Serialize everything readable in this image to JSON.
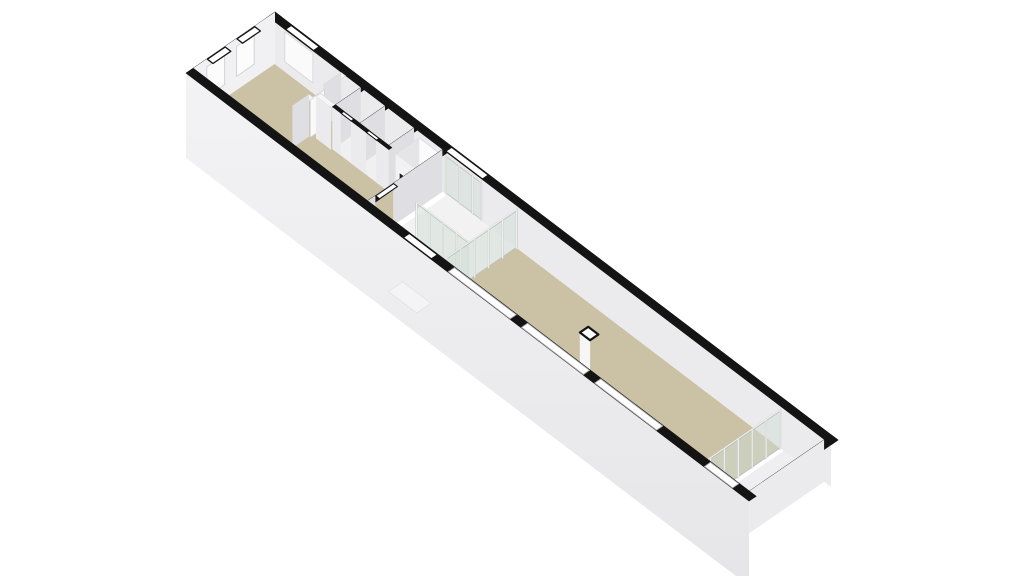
{
  "meta": {
    "description": "3D axonometric floor plan of a long narrow building",
    "background": "#ffffff",
    "rooms": [
      "living-room",
      "bathroom",
      "entrance-hall",
      "main-hall",
      "end-room"
    ]
  },
  "palette": {
    "black": "#141414",
    "tan": "#cbc1a5",
    "vest": "#f2f2f3",
    "podFloor": "#f0f0f1",
    "end": "#efeff1",
    "topWhite": "#f5f5f6",
    "topStroke": "#d8d8db",
    "faceS": "#ebebed",
    "faceW": "#dfdfe3",
    "extFace": "#f1f1f3",
    "extGrad": "url(#ext)",
    "win": "#ffffff",
    "winExt": "#fcfcfd",
    "winGlassInner": "#fafafa",
    "frame": "#d3d3d7",
    "door": "#f9f9fa",
    "cabTop": "#fbfbfc",
    "cabW": "#e5e5e8",
    "cabS": "#f2f2f4",
    "panel": "#1e1e1e",
    "colW": "#e9e9ec",
    "colS": "#f6f6f7",
    "stoop": "#f4f4f6",
    "stoopEdge": "#e2e2e5",
    "longWin": "#a6a6ab",
    "glassFill": "rgba(208,221,214,0.5)",
    "glassStroke": "#b9c1bb",
    "post": "#f6f6f7",
    "postStroke": "#c6cbc7",
    "rail": "#f8f8f9"
  },
  "projection": {
    "origin": [
      275,
      54
    ],
    "axis_x": [
      5.63,
      4.28
    ],
    "axis_y": [
      -5.93,
      4.07
    ],
    "wall_height_px": 42,
    "plinth_bottom_px": -43,
    "post_interval": 2.35
  },
  "building": {
    "length_units": 100,
    "width_units": 15,
    "wall_thickness": 1.2
  },
  "scene": [
    {
      "t": "top",
      "r": [
        0,
        0,
        100,
        1.2
      ],
      "h": 42,
      "f": "black",
      "s": "black",
      "sw": 0.6,
      "name": "north-facade-wall-top"
    },
    {
      "t": "faceS",
      "x1": 0,
      "x2": 100,
      "y": 1.2,
      "h1": 42,
      "h2": 0,
      "f": "faceS",
      "name": "north-facade-inner-face"
    },
    {
      "t": "faceS",
      "x1": 3,
      "x2": 8,
      "y": 1.2,
      "h1": 40,
      "h2": 10,
      "f": "winGlassInner",
      "s": "frame",
      "sw": 0.8,
      "name": "north-window-inner-pane"
    },
    {
      "t": "glass",
      "axis": "x",
      "at": 1.2,
      "from": 31.5,
      "to": 38,
      "hh": 40,
      "name": "entry-glazing-inner"
    },
    {
      "t": "band",
      "r": [
        3,
        0.12,
        8,
        1.08
      ],
      "h": 42,
      "f": "win",
      "s": "black",
      "sw": 1.3,
      "name": "north-window-cut"
    },
    {
      "t": "band",
      "r": [
        31.5,
        0.12,
        38,
        1.08
      ],
      "h": 42,
      "f": "win",
      "s": "black",
      "sw": 1.1,
      "name": "entry-glazing-cut"
    },
    {
      "t": "top",
      "r": [
        0,
        0,
        1.2,
        15
      ],
      "h": 42,
      "f": "black",
      "s": "black",
      "sw": 0.6,
      "name": "west-end-wall-top"
    },
    {
      "t": "faceW",
      "x": 0,
      "y1": 0,
      "y2": 15,
      "h1": 42,
      "h2": -43,
      "f": "extFace",
      "name": "west-end-exterior-face"
    },
    {
      "t": "faceW",
      "x": 0,
      "y1": 3.5,
      "y2": 6.5,
      "h1": 34,
      "h2": 4,
      "f": "winExt",
      "s": "frame",
      "sw": 1,
      "name": "west-window-1"
    },
    {
      "t": "faceW",
      "x": 0,
      "y1": 8.5,
      "y2": 11.5,
      "h1": 34,
      "h2": 4,
      "f": "winExt",
      "s": "frame",
      "sw": 1,
      "name": "west-window-2"
    },
    {
      "t": "band",
      "r": [
        0.1,
        3.5,
        1.1,
        6.5
      ],
      "h": 42,
      "f": "win",
      "s": "black",
      "sw": 1.3,
      "name": "west-window-1-cut"
    },
    {
      "t": "band",
      "r": [
        0.1,
        8.5,
        1.1,
        11.5
      ],
      "h": 42,
      "f": "win",
      "s": "black",
      "sw": 1.3,
      "name": "west-window-2-cut"
    },
    {
      "t": "top",
      "r": [
        1.2,
        1.2,
        31,
        13.8
      ],
      "h": 0,
      "f": "tan",
      "name": "living-room-floor"
    },
    {
      "t": "top",
      "r": [
        31.8,
        1.2,
        44,
        13.8
      ],
      "h": 0,
      "f": "vest",
      "name": "entrance-hall-floor"
    },
    {
      "t": "top",
      "r": [
        16.5,
        1.2,
        26.5,
        6
      ],
      "h": 0,
      "f": "podFloor",
      "name": "bathroom-floor"
    },
    {
      "t": "top",
      "r": [
        44,
        1.2,
        91,
        13.8
      ],
      "h": 0,
      "f": "tan",
      "name": "main-hall-floor"
    },
    {
      "t": "top",
      "r": [
        91.6,
        1.2,
        98.8,
        13.8
      ],
      "h": 0,
      "f": "end",
      "name": "end-room-floor"
    },
    {
      "t": "top",
      "r": [
        13,
        1.2,
        13.8,
        4.2
      ],
      "h": 42,
      "f": "topWhite",
      "s": "topStroke",
      "sw": 0.7,
      "name": "partition-wall-top"
    },
    {
      "t": "faceW",
      "x": 13,
      "y1": 1.2,
      "y2": 4.2,
      "h1": 42,
      "h2": 0,
      "f": "faceW",
      "name": "partition-wall-face"
    },
    {
      "t": "faceW",
      "x": 13.2,
      "y1": 4.2,
      "y2": 6.6,
      "h1": 38,
      "h2": 0,
      "f": "door",
      "s": "frame",
      "sw": 0.8,
      "name": "interior-door"
    },
    {
      "t": "top",
      "r": [
        13,
        6.6,
        13.8,
        9.4
      ],
      "h": 42,
      "f": "topWhite",
      "s": "topStroke",
      "sw": 0.7,
      "name": "partition-wall-top"
    },
    {
      "t": "faceW",
      "x": 13,
      "y1": 6.6,
      "y2": 9.4,
      "h1": 42,
      "h2": 0,
      "f": "faceW",
      "name": "partition-wall-face"
    },
    {
      "t": "top",
      "r": [
        13.8,
        5.45,
        16.5,
        6.2
      ],
      "h": 42,
      "f": "topWhite",
      "s": "topStroke",
      "sw": 0.7,
      "name": "hall-wall-top"
    },
    {
      "t": "faceS",
      "x1": 13.8,
      "x2": 16.5,
      "y": 6.2,
      "h1": 42,
      "h2": 0,
      "f": "faceS",
      "name": "hall-wall-face"
    },
    {
      "t": "top",
      "r": [
        16.5,
        1.2,
        17.05,
        6
      ],
      "h": 42,
      "f": "black",
      "s": "black",
      "sw": 0.6,
      "name": "bathroom-wall-top"
    },
    {
      "t": "faceW",
      "x": 16.5,
      "y1": 1.2,
      "y2": 6,
      "h1": 42,
      "h2": 0,
      "f": "faceW",
      "name": "bathroom-wall-face"
    },
    {
      "t": "top",
      "r": [
        20.8,
        1.2,
        21.35,
        5.45
      ],
      "h": 42,
      "f": "black",
      "s": "black",
      "sw": 0.6,
      "name": "bathroom-divider-top"
    },
    {
      "t": "faceW",
      "x": 20.8,
      "y1": 1.2,
      "y2": 5.45,
      "h1": 42,
      "h2": 0,
      "f": "faceW",
      "name": "bathroom-divider-face"
    },
    {
      "t": "top",
      "r": [
        25.95,
        1.2,
        26.5,
        6
      ],
      "h": 42,
      "f": "black",
      "s": "black",
      "sw": 0.6,
      "name": "bathroom-wall-top"
    },
    {
      "t": "faceW",
      "x": 25.95,
      "y1": 1.2,
      "y2": 6,
      "h1": 42,
      "h2": 0,
      "f": "faceW",
      "name": "bathroom-wall-face"
    },
    {
      "t": "top",
      "r": [
        16.5,
        5.45,
        18,
        6
      ],
      "h": 42,
      "f": "black",
      "s": "black",
      "sw": 0.6,
      "name": "bathroom-wall-top"
    },
    {
      "t": "top",
      "r": [
        19.8,
        5.45,
        22.5,
        6
      ],
      "h": 42,
      "f": "black",
      "s": "black",
      "sw": 0.6,
      "name": "bathroom-wall-top"
    },
    {
      "t": "top",
      "r": [
        24.3,
        5.45,
        26.5,
        6
      ],
      "h": 42,
      "f": "black",
      "s": "black",
      "sw": 0.6,
      "name": "bathroom-wall-top"
    },
    {
      "t": "faceS",
      "x1": 16.5,
      "x2": 18,
      "y": 6,
      "h1": 42,
      "h2": 0,
      "f": "faceS",
      "name": "bathroom-wall-face"
    },
    {
      "t": "faceS",
      "x1": 19.8,
      "x2": 22.5,
      "y": 6,
      "h1": 42,
      "h2": 0,
      "f": "faceS",
      "name": "bathroom-wall-face"
    },
    {
      "t": "faceS",
      "x1": 24.3,
      "x2": 26.5,
      "y": 6,
      "h1": 42,
      "h2": 0,
      "f": "faceS",
      "name": "bathroom-wall-face"
    },
    {
      "t": "band",
      "r": [
        18,
        5.5,
        19.8,
        5.95
      ],
      "h": 42,
      "f": "win",
      "s": "black",
      "sw": 1.1,
      "name": "bathroom-door"
    },
    {
      "t": "band",
      "r": [
        22.5,
        5.5,
        24.3,
        5.95
      ],
      "h": 42,
      "f": "win",
      "s": "black",
      "sw": 1.1,
      "name": "bathroom-door"
    },
    {
      "t": "top",
      "r": [
        26.9,
        1.2,
        31,
        5.2
      ],
      "h": 36,
      "f": "cabTop",
      "s": "topStroke",
      "sw": 0.7,
      "name": "cabinet-top"
    },
    {
      "t": "faceW",
      "x": 26.9,
      "y1": 1.2,
      "y2": 5.2,
      "h1": 36,
      "h2": 0,
      "f": "cabW",
      "name": "cabinet-side"
    },
    {
      "t": "faceS",
      "x1": 26.9,
      "x2": 31,
      "y": 5.2,
      "h1": 36,
      "h2": 0,
      "f": "cabS",
      "name": "cabinet-front"
    },
    {
      "t": "faceS",
      "x1": 27.5,
      "x2": 28.85,
      "y": 5.2,
      "h1": 21,
      "h2": 8,
      "f": "panel",
      "s": "win",
      "sw": 1.2,
      "name": "cabinet-panel"
    },
    {
      "t": "faceS",
      "x1": 29.15,
      "x2": 30.5,
      "y": 5.2,
      "h1": 21,
      "h2": 8,
      "f": "panel",
      "s": "win",
      "sw": 1.2,
      "name": "cabinet-panel"
    },
    {
      "t": "top",
      "r": [
        31,
        1.2,
        31.8,
        9.5
      ],
      "h": 42,
      "f": "black",
      "s": "black",
      "sw": 0.6,
      "name": "hall-partition-top"
    },
    {
      "t": "faceW",
      "x": 31,
      "y1": 1.2,
      "y2": 9.5,
      "h1": 42,
      "h2": 0,
      "f": "faceW",
      "name": "hall-partition-face"
    },
    {
      "t": "top",
      "r": [
        31,
        12.5,
        31.8,
        13.8
      ],
      "h": 42,
      "f": "black",
      "s": "black",
      "sw": 0.6,
      "name": "hall-partition-top"
    },
    {
      "t": "faceW",
      "x": 31,
      "y1": 12.5,
      "y2": 13.8,
      "h1": 42,
      "h2": 0,
      "f": "faceW",
      "name": "hall-partition-face"
    },
    {
      "t": "band",
      "r": [
        31.05,
        9.5,
        31.75,
        12.5
      ],
      "h": 42,
      "f": "win",
      "s": "black",
      "sw": 1.1,
      "name": "hall-doorway"
    },
    {
      "t": "glass",
      "axis": "x",
      "at": 9.1,
      "from": 34.6,
      "to": 44,
      "hh": 38,
      "name": "vestibule-glass-side"
    },
    {
      "t": "glass",
      "axis": "y",
      "at": 44.3,
      "from": 1.2,
      "to": 13.8,
      "hh": 40,
      "name": "vestibule-glass-front"
    },
    {
      "t": "faceW",
      "x": 64.8,
      "y1": 8.7,
      "y2": 10.1,
      "h1": 40,
      "h2": 0,
      "f": "colW",
      "name": "flue-side"
    },
    {
      "t": "faceS",
      "x1": 64.8,
      "x2": 66.6,
      "y": 10.1,
      "h1": 40,
      "h2": 0,
      "f": "colS",
      "name": "flue-front"
    },
    {
      "t": "top",
      "r": [
        64.8,
        8.7,
        66.6,
        10.1
      ],
      "h": 40,
      "f": "win",
      "s": "black",
      "sw": 2.2,
      "name": "flue-top"
    },
    {
      "t": "glass",
      "axis": "y",
      "at": 91.1,
      "from": 1.2,
      "to": 13.8,
      "hh": 40,
      "name": "end-room-glass"
    },
    {
      "t": "top",
      "r": [
        98.8,
        0,
        100,
        15
      ],
      "h": 42,
      "f": "black",
      "s": "black",
      "sw": 0.6,
      "name": "east-end-wall-top"
    },
    {
      "t": "faceW",
      "x": 98.8,
      "y1": 1.2,
      "y2": 13.8,
      "h1": 42,
      "h2": 0,
      "f": "faceS",
      "name": "east-end-inner-face"
    },
    {
      "t": "faceS",
      "x1": 0,
      "x2": 100,
      "y": 15,
      "h1": 42,
      "h2": -43,
      "f": "extGrad",
      "name": "south-facade-exterior"
    },
    {
      "t": "top",
      "r": [
        38.5,
        15,
        43.5,
        17.4
      ],
      "h": -2,
      "f": "stoop",
      "s": "stoopEdge",
      "sw": 0.8,
      "name": "entrance-step"
    },
    {
      "t": "top",
      "r": [
        0,
        13.8,
        100,
        15
      ],
      "h": 42,
      "f": "black",
      "s": "black",
      "sw": 0.6,
      "name": "south-facade-wall-top"
    },
    {
      "t": "band",
      "r": [
        46.5,
        13.9,
        57.5,
        14.92
      ],
      "h": 42,
      "f": "win",
      "s": "longWin",
      "sw": 0.9,
      "name": "south-window"
    },
    {
      "t": "band",
      "r": [
        59.5,
        13.9,
        70.5,
        14.92
      ],
      "h": 42,
      "f": "win",
      "s": "longWin",
      "sw": 0.9,
      "name": "south-window"
    },
    {
      "t": "band",
      "r": [
        72.5,
        13.9,
        83.5,
        14.92
      ],
      "h": 42,
      "f": "win",
      "s": "longWin",
      "sw": 0.9,
      "name": "south-window"
    },
    {
      "t": "band",
      "r": [
        92,
        13.9,
        97,
        14.92
      ],
      "h": 42,
      "f": "win",
      "s": "longWin",
      "sw": 0.9,
      "name": "end-room-window"
    },
    {
      "t": "band",
      "r": [
        38.5,
        13.9,
        43.5,
        14.92
      ],
      "h": 42,
      "f": "win",
      "s": "black",
      "sw": 1.2,
      "name": "entrance-door"
    }
  ]
}
